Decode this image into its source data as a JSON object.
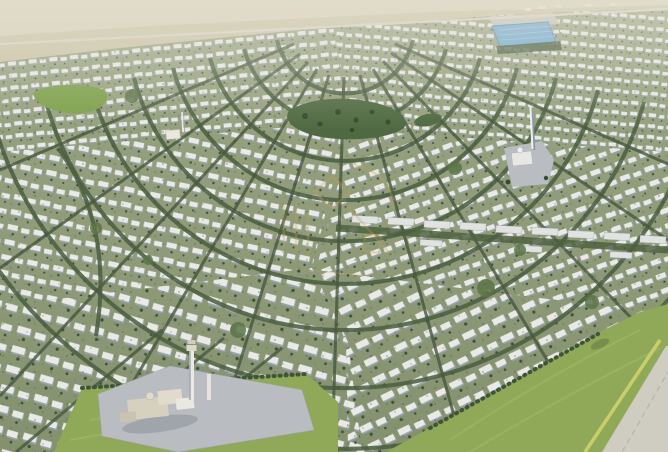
{
  "scene": {
    "type": "aerial-render",
    "subject": "masterplan villa community aerial 3D render",
    "view": "high oblique birds-eye",
    "time_of_day": "day-hazy"
  },
  "palette": {
    "ground_top": "#9aa584",
    "ground_bottom": "#84916e",
    "villa": "#e9eae6",
    "villa_shadow": "#98a3ae",
    "tree_dark": "#3d5136",
    "park": "#4f6a42",
    "park_bright": "#7ca04b",
    "lawn": "#8fa958",
    "lawn_light": "#a3bb6b",
    "hedge": "#c9ce6b",
    "plaza_gray": "#b9bdc2",
    "corner_road": "#cfccc2",
    "desert": "#cbc4a8",
    "desert_light": "#d9d3bd",
    "highway": "#d8d4c4",
    "pool_blue": "#6fa9d2",
    "pool_rib": "#8cbcdd",
    "watermark_gold": "#c9a24a"
  },
  "landmarks": [
    {
      "name": "desert-horizon",
      "position": "top edge"
    },
    {
      "name": "highway",
      "position": "along horizon"
    },
    {
      "name": "pool-facility",
      "position": "top right",
      "roof": "blue"
    },
    {
      "name": "left-park",
      "position": "upper left"
    },
    {
      "name": "central-park",
      "position": "center"
    },
    {
      "name": "community-mosque",
      "position": "center right"
    },
    {
      "name": "small-mosque",
      "position": "upper left"
    },
    {
      "name": "utility-mosque-plot",
      "position": "bottom left",
      "plot": "gray paved"
    },
    {
      "name": "community-lawn",
      "position": "bottom right"
    },
    {
      "name": "perimeter-road",
      "position": "bottom right corner"
    },
    {
      "name": "watermark-logo",
      "position": "center",
      "style": "faint gold emblem"
    }
  ]
}
